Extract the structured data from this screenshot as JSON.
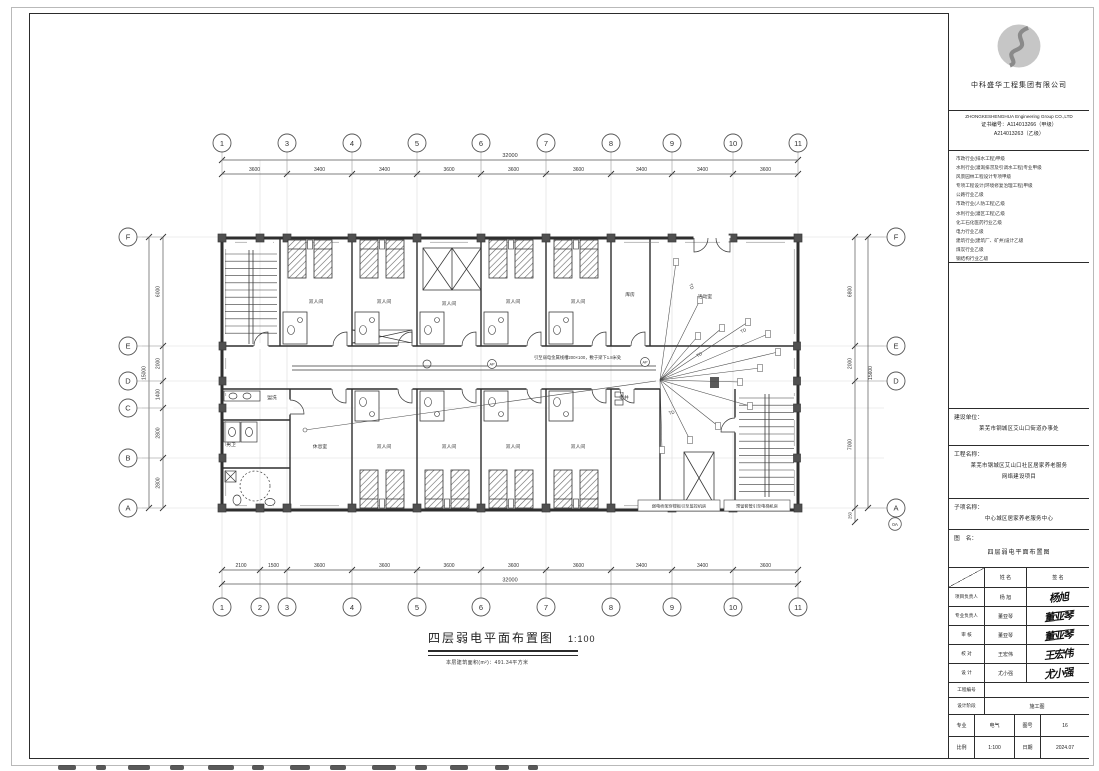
{
  "title_block": {
    "company_cn": "中科盛华工程集团有限公司",
    "company_en": "ZHONGKESHENGHUA Engineering Group CO.,LTD",
    "cert_label": "证书编号：",
    "cert_no_1": "A114013266（甲级）",
    "cert_no_2": "A214013263（乙级）",
    "qualifications": [
      "市政行业(排水工程)甲级",
      "水利行业(灌溉排涝及引调水工程)专业甲级",
      "风景园林工程设计专项甲级",
      "专项工程设计(环境修复治理工程)甲级",
      "公路行业乙级",
      "市政行业(人防工程)乙级",
      "水利行业(灌区工程)乙级",
      "化工石化医药行业乙级",
      "电力行业乙级",
      "建筑行业(建筑厂、矿井)设计乙级",
      "煤炭行业乙级",
      "钢结构行业乙级"
    ],
    "client_label": "建设单位：",
    "client": "莱芜市钢城区艾山口街道办事处",
    "project_label": "工程名称：",
    "project_line1": "莱芜市钢城区艾山口社区居家养老服务",
    "project_line2": "网络建设项目",
    "subitem_label": "子项名称：",
    "subitem": "中心城区居家养老服务中心",
    "drawing_name_label": "图　名：",
    "drawing_name": "四层弱电平面布置图",
    "sign_table": {
      "col_name": "姓 名",
      "col_sign": "签 名",
      "rows": [
        {
          "role": "项目负责人",
          "name": "杨  旭",
          "sign": "杨旭"
        },
        {
          "role": "专业负责人",
          "name": "董亚琴",
          "sign": "董亚琴"
        },
        {
          "role": "审  核",
          "name": "董亚琴",
          "sign": "董亚琴"
        },
        {
          "role": "校  对",
          "name": "王宏伟",
          "sign": "王宏伟"
        },
        {
          "role": "设  计",
          "name": "尤小强",
          "sign": "尤小强"
        }
      ],
      "project_no_label": "工程编号",
      "stage_label": "设计阶段",
      "stage": "施工图",
      "major_label": "专业",
      "major": "电气",
      "sheet_label": "图号",
      "sheet": "16",
      "scale_label": "比例",
      "scale": "1:100",
      "date_label": "日期",
      "date": "2024.07"
    }
  },
  "drawing_title": {
    "title": "四层弱电平面布置图",
    "scale": "1:100",
    "area_note": "本层建筑面积(m²)：491.34平方米"
  },
  "grid": {
    "top_bubbles": [
      "1",
      "3",
      "4",
      "5",
      "6",
      "7",
      "8",
      "9",
      "10",
      "11"
    ],
    "bottom_bubbles": [
      "1",
      "2",
      "3",
      "4",
      "5",
      "6",
      "7",
      "8",
      "9",
      "10",
      "11"
    ],
    "left_bubbles": [
      "F",
      "E",
      "D",
      "C",
      "B",
      "A"
    ],
    "right_bubbles": [
      "F",
      "E",
      "D",
      "A",
      "0A"
    ],
    "top_dims": [
      "3600",
      "3400",
      "3400",
      "3600",
      "3600",
      "3600",
      "3400",
      "3400",
      "3600"
    ],
    "top_total": "32000",
    "bottom_dims": [
      "2100",
      "1500",
      "3600",
      "3600",
      "3600",
      "3600",
      "3600",
      "3400",
      "3400",
      "3600"
    ],
    "bottom_total": "32000",
    "left_dims": [
      "6000",
      "2000",
      "1400",
      "2800",
      "2800"
    ],
    "left_total": "15000",
    "right_dims": [
      "6800",
      "2000",
      "7000"
    ],
    "right_total": "15600",
    "right_bottom_dim": "250"
  },
  "plan": {
    "labels": [
      {
        "t": "双人间",
        "x": 316,
        "y": 303
      },
      {
        "t": "双人间",
        "x": 384,
        "y": 303
      },
      {
        "t": "双人间",
        "x": 449,
        "y": 305
      },
      {
        "t": "双人间",
        "x": 513,
        "y": 303
      },
      {
        "t": "双人间",
        "x": 578,
        "y": 303
      },
      {
        "t": "库房",
        "x": 630,
        "y": 296
      },
      {
        "t": "活动室",
        "x": 705,
        "y": 298
      },
      {
        "t": "盥洗",
        "x": 272,
        "y": 399
      },
      {
        "t": "男卫",
        "x": 231,
        "y": 446
      },
      {
        "t": "休息室",
        "x": 320,
        "y": 448
      },
      {
        "t": "双人间",
        "x": 384,
        "y": 448
      },
      {
        "t": "双人间",
        "x": 449,
        "y": 448
      },
      {
        "t": "双人间",
        "x": 513,
        "y": 448
      },
      {
        "t": "双人间",
        "x": 578,
        "y": 448
      },
      {
        "t": "电井",
        "x": 624,
        "y": 399
      }
    ],
    "device_marks": [
      {
        "t": "AP",
        "x": 492,
        "y": 364
      },
      {
        "t": "AP",
        "x": 645,
        "y": 362
      }
    ],
    "td_labels": [
      {
        "t": "TD",
        "x": 700,
        "y": 356,
        "r": -30
      },
      {
        "t": "TD",
        "x": 672,
        "y": 414,
        "r": -15
      },
      {
        "t": "TD",
        "x": 690,
        "y": 287,
        "r": 70
      },
      {
        "t": "TD",
        "x": 744,
        "y": 332,
        "r": -25
      }
    ],
    "beam_note": "引至弱电金属线槽200×100，敷于梁下1.8米处",
    "note_left": "弱电桥架穿楼板引至监控机房",
    "note_right": "预留套管引至电梯机房"
  }
}
